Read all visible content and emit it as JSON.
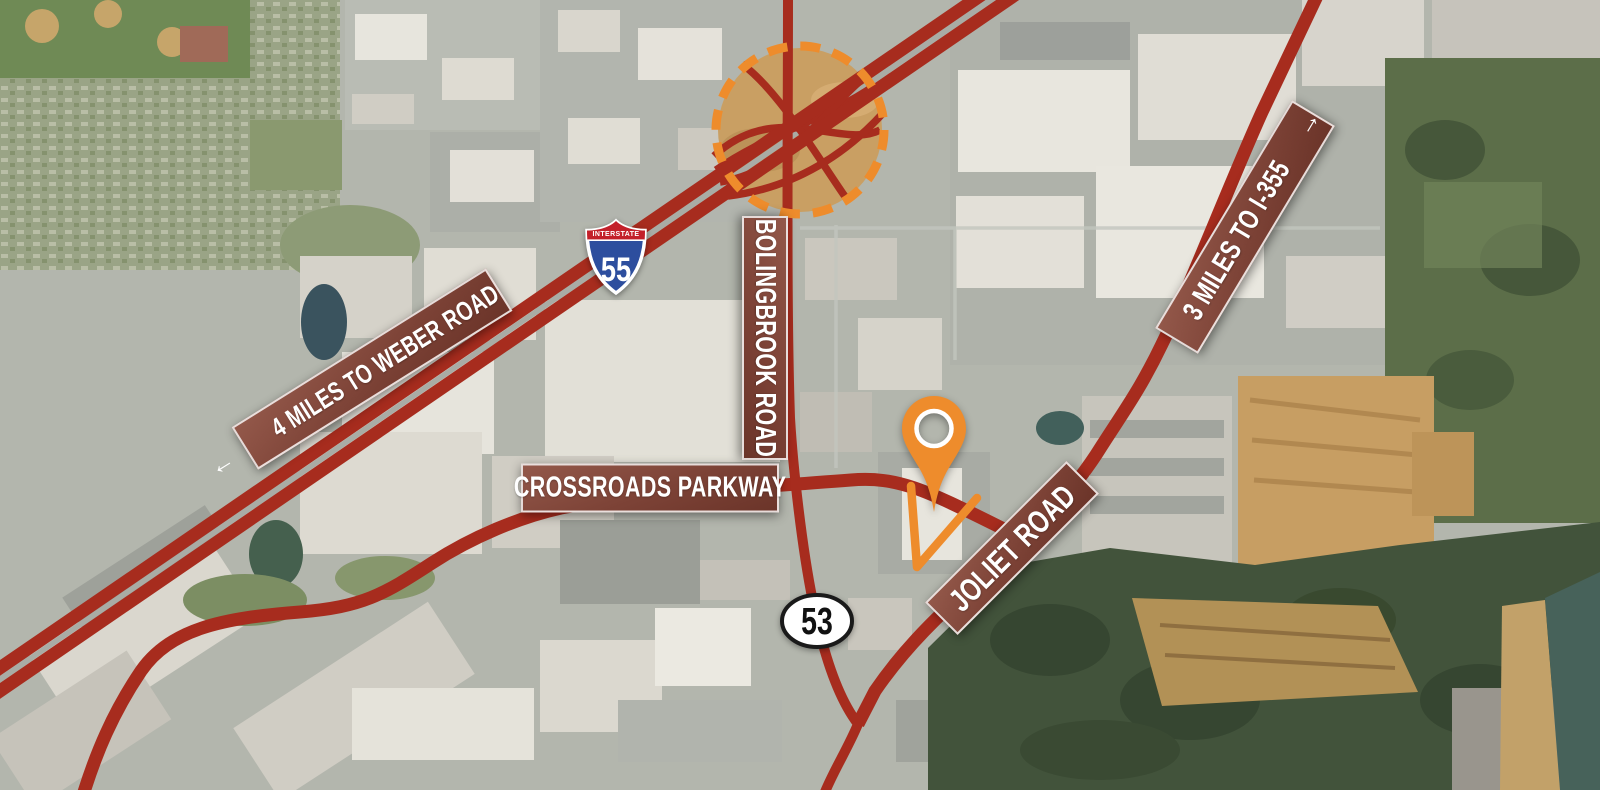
{
  "map": {
    "labels": {
      "weber": {
        "arrow": "←",
        "text": "4 MILES TO WEBER ROAD"
      },
      "i355": {
        "text": "3 MILES TO I-355",
        "arrow": "→"
      },
      "bolingbrook": {
        "text": "BOLINGBROOK ROAD"
      },
      "crossroads": {
        "text": "CROSSROADS PARKWAY"
      },
      "joliet": {
        "text": "JOLIET ROAD"
      }
    },
    "shields": {
      "interstate": {
        "band": "INTERSTATE",
        "number": "55"
      },
      "route53": {
        "number": "53"
      }
    },
    "colors": {
      "road": "#A72C1E",
      "orange": "#EE8C2C",
      "label_box": "#7E4337",
      "shield_blue": "#2D4E9E",
      "shield_red": "#C3202A",
      "route_oval_fill": "#FFFFFF"
    }
  }
}
